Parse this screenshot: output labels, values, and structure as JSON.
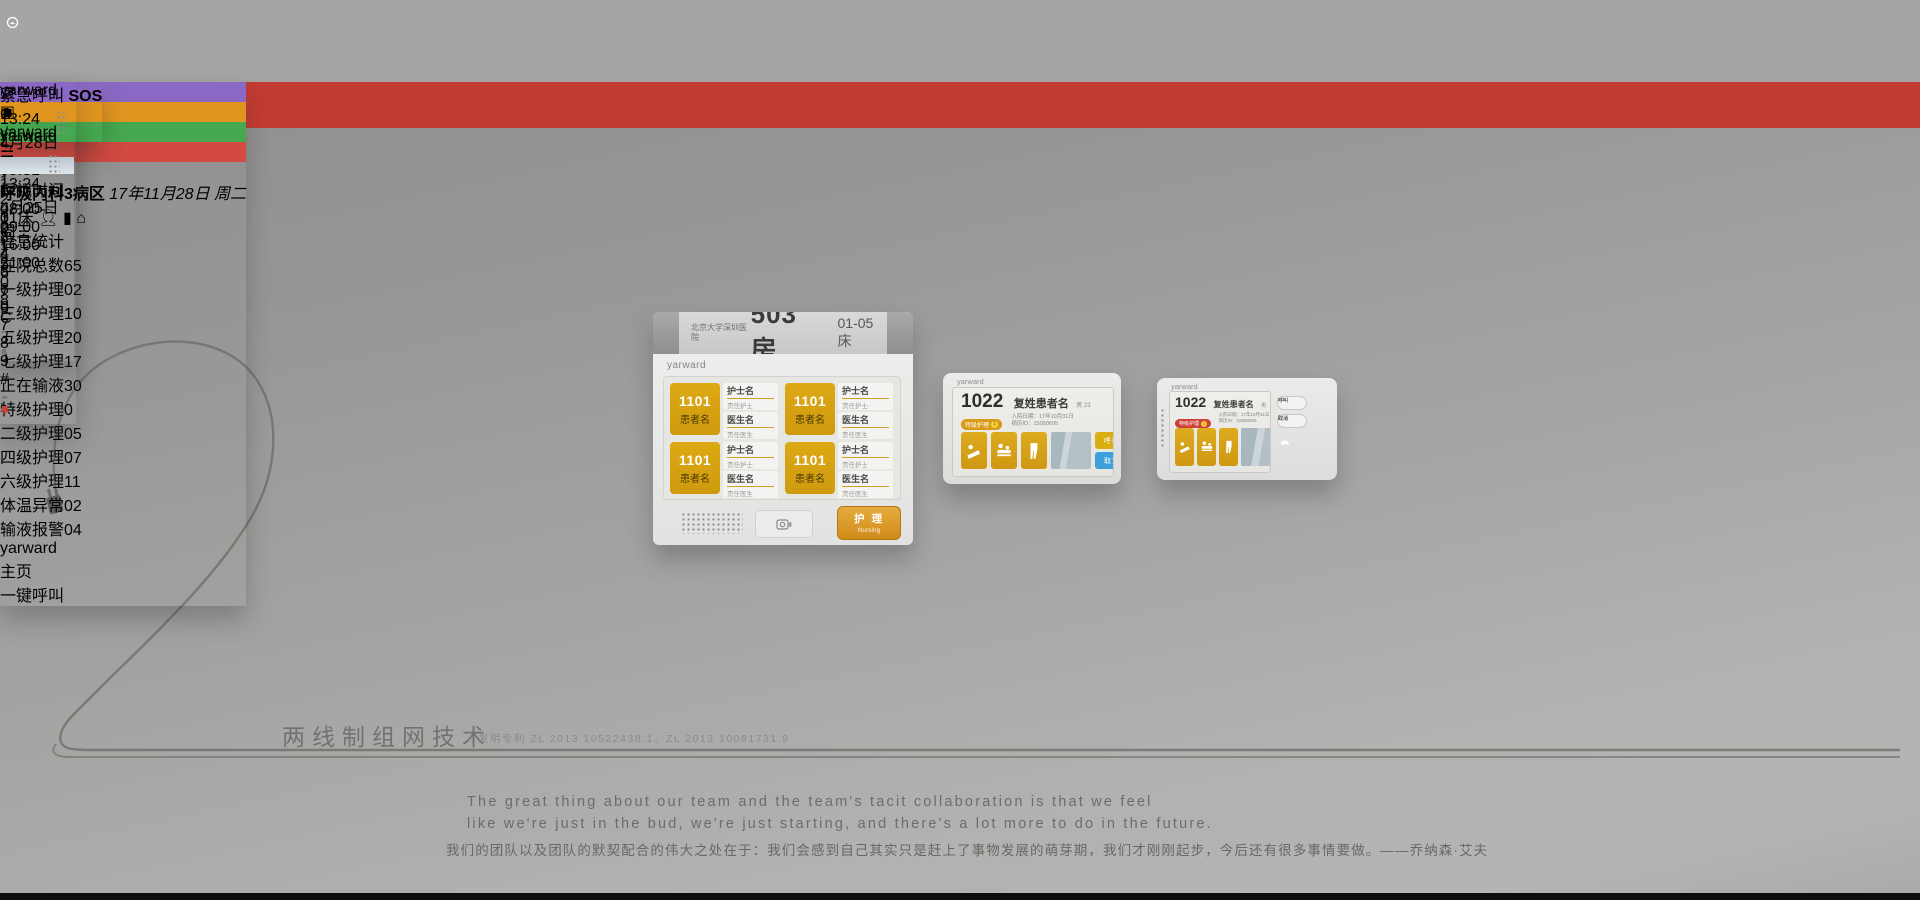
{
  "brand": "yarward",
  "colors": {
    "accent_orange": "#d7a113",
    "accent_red": "#cf4a43",
    "accent_blue": "#3f9fd8",
    "cable_gray": "#6f6f6d"
  },
  "tagline": {
    "title": "两线制组网技术",
    "patent": "发明专利 ZL 2013 10522438.1、ZL 2013 10081731.9"
  },
  "quote": {
    "en_line1": "The great thing about our team and the team's tacit collaboration is that we feel",
    "en_line2": "like we're just in the bud, we're just starting, and there's a lot more to do in the future.",
    "zh_line": "我们的团队以及团队的默契配合的伟大之处在于：我们会感到自己其实只是赶上了事物发展的萌芽期，我们才刚刚起步，今后还有很多事情要做。——乔纳森·艾夫"
  },
  "corridor_display": {
    "hospital": "北京大学深圳医院",
    "room": "503房",
    "beds": "01-05床",
    "brand": "yarward",
    "card": {
      "bed": "1101",
      "patient": "患者名",
      "nurse": "护士名",
      "nurse_role": "责任护士",
      "doctor": "医生名",
      "doctor_role": "责任医生"
    },
    "nursing_button": {
      "zh": "护 理",
      "en": "Nursing"
    }
  },
  "door_display": {
    "brand": "yarward",
    "room": "1022",
    "patient": "复姓患者名",
    "patient_meta": "男 23",
    "care_badge": "特级护理",
    "care_level": "1",
    "admit_line": "入院日期：17年10月31日",
    "record_line": "病历ID：15050605",
    "btn_call": "呼叫",
    "btn_cancel": "取消"
  },
  "console": {
    "brand": "yarward",
    "time": "09:31",
    "department": "呼吸内科3病区",
    "date": "17年11月28日 周二",
    "bed": "01床",
    "stats_title": "信息统计",
    "stats_left": [
      {
        "label": "在院总数",
        "value": "65",
        "dot": ""
      },
      {
        "label": "一级护理",
        "value": "02",
        "dot": "#e0d322"
      },
      {
        "label": "三级护理",
        "value": "10",
        "dot": "#2cc4c4"
      },
      {
        "label": "五级护理",
        "value": "20",
        "dot": "#c238c2"
      },
      {
        "label": "七级护理",
        "value": "17",
        "dot": "#f6f6f4"
      },
      {
        "label": "正在输液",
        "value": "30",
        "dot": ""
      }
    ],
    "stats_right": [
      {
        "label": "特级护理",
        "value": "0",
        "dot": "#dd3330"
      },
      {
        "label": "二级护理",
        "value": "05",
        "dot": "#2fb23a"
      },
      {
        "label": "四级护理",
        "value": "07",
        "dot": "#2b5ad4"
      },
      {
        "label": "六级护理",
        "value": "11",
        "dot": "#dd9c17"
      },
      {
        "label": "体温异常",
        "value": "02",
        "dot": ""
      },
      {
        "label": "输液报警",
        "value": "04",
        "dot": ""
      }
    ],
    "btn_home": "主页",
    "btn_call": "一键呼叫"
  },
  "bedside_a": {
    "brand": "yarward",
    "time": "13:24",
    "date": "4月28日 周二",
    "visit_tag": "探视时间",
    "visit_time_1": "08:00-09:00",
    "visit_time_2": "16:00-21:00",
    "keypad": [
      [
        "1",
        "2",
        "3",
        "*"
      ],
      [
        "4",
        "5",
        "6",
        "0"
      ],
      [
        "7",
        "8",
        "9",
        "#"
      ]
    ]
  },
  "sos_device": {
    "brand": "yarward",
    "label": "紧急呼叫",
    "sos": "SOS"
  },
  "bedside_b": {
    "brand": "yarward",
    "time": "13:24",
    "date": "4月25日 周三",
    "keypad": [
      [
        "1",
        "2",
        "3",
        "*"
      ],
      [
        "4",
        "5",
        "6",
        "0"
      ],
      [
        "7",
        "8",
        "9",
        "C"
      ]
    ]
  }
}
